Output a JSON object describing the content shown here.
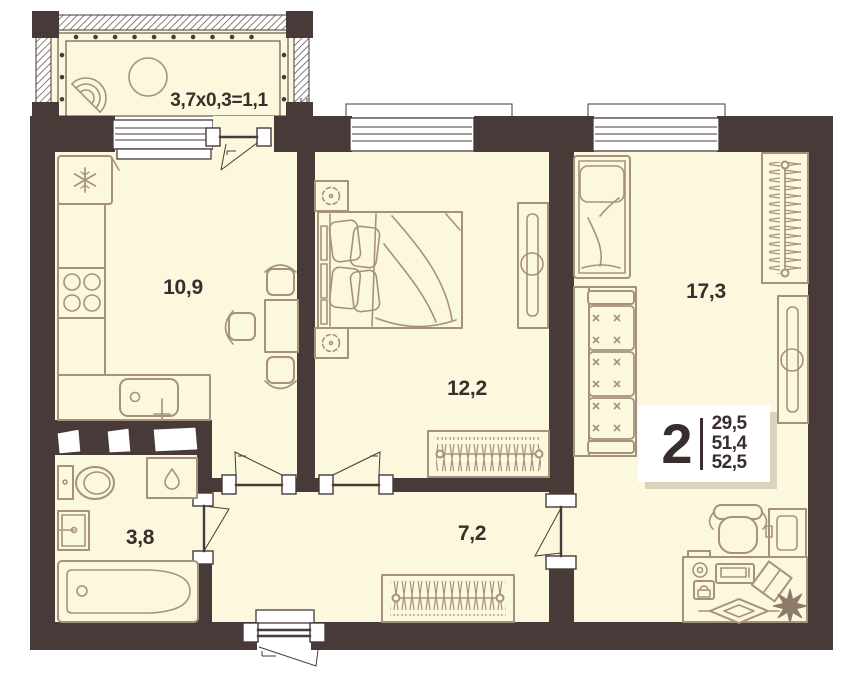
{
  "meta": {
    "type": "apartment-floor-plan",
    "rooms_total": "2"
  },
  "colors": {
    "wall": "#473a38",
    "floor": "#fbf8dd",
    "furniture_outline": "#a6927c",
    "text": "#3a2d2e",
    "window": "#ffffff",
    "stamp_shadow": "#d9d2bc",
    "background": "#ffffff"
  },
  "rooms": {
    "balcony": {
      "label": "3,7x0,3=1,1"
    },
    "kitchen": {
      "area": "10,9"
    },
    "bedroom": {
      "area": "12,2"
    },
    "living_room": {
      "area": "17,3"
    },
    "hallway": {
      "area": "7,2"
    },
    "bathroom": {
      "area": "3,8"
    }
  },
  "stamp": {
    "rooms_count": "2",
    "areas": [
      "29,5",
      "51,4",
      "52,5"
    ]
  },
  "furniture_icons": {
    "balcony": [
      "fan-chair-icon",
      "round-table-icon"
    ],
    "kitchen": [
      "fridge-icon",
      "counter-icon",
      "stove-icon",
      "sink-icon",
      "dining-table-icon",
      "chair-icon"
    ],
    "bedroom": [
      "double-bed-icon",
      "nightstand-plant-icon",
      "wardrobe-icon",
      "hanger-wardrobe-icon"
    ],
    "living_room": [
      "single-bed-icon",
      "sofa-icon",
      "hanger-wardrobe-icon",
      "wardrobe-icon",
      "desk-icon",
      "office-chair-icon",
      "tv-shelf-icon",
      "mug-icon",
      "laptop-icon",
      "phone-icon",
      "book-icon",
      "plant-icon",
      "decor-icon"
    ],
    "bathroom": [
      "toilet-icon",
      "washing-machine-icon",
      "sink-icon",
      "bathtub-icon"
    ],
    "hallway": [
      "hanger-wardrobe-icon"
    ]
  }
}
